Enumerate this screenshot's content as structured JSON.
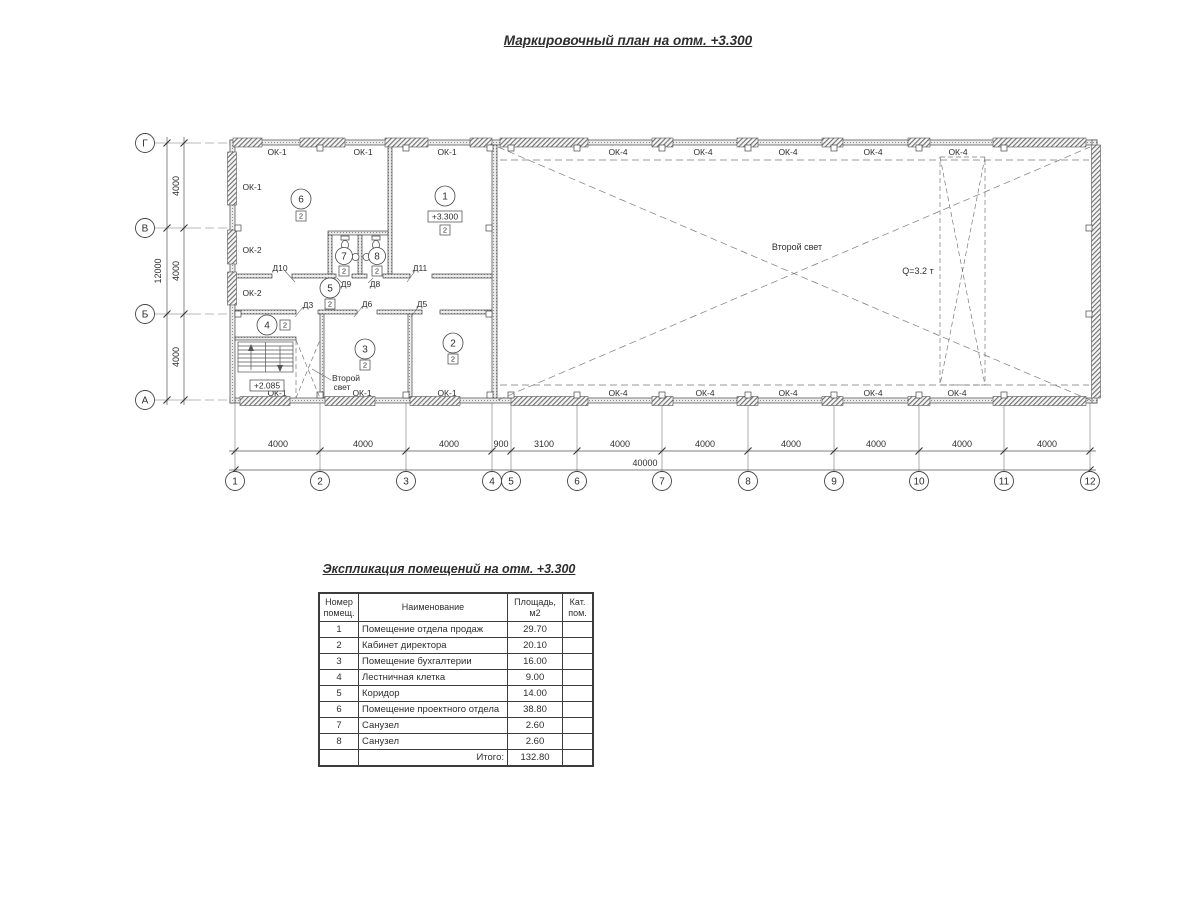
{
  "titles": {
    "plan": "Маркировочный план на отм. +3.300",
    "table": "Экспликация помещений на отм. +3.300"
  },
  "plan": {
    "axis_rows": [
      "Г",
      "В",
      "Б",
      "А"
    ],
    "axis_cols": [
      "1",
      "2",
      "3",
      "4",
      "5",
      "6",
      "7",
      "8",
      "9",
      "10",
      "11",
      "12"
    ],
    "dim_bottom": [
      "4000",
      "4000",
      "4000",
      "900",
      "3100",
      "4000",
      "4000",
      "4000",
      "4000",
      "4000",
      "4000"
    ],
    "dim_bottom_total": "40000",
    "dim_left": [
      "4000",
      "4000",
      "4000"
    ],
    "dim_left_total": "12000",
    "windows_left": [
      "ОК-1",
      "ОК-2",
      "ОК-2"
    ],
    "windows_top_office": [
      "ОК-1",
      "ОК-1",
      "ОК-1"
    ],
    "windows_top_hall": [
      "ОК-4",
      "ОК-4",
      "ОК-4",
      "ОК-4",
      "ОК-4"
    ],
    "windows_bottom_office": [
      "ОК-1",
      "ОК-1",
      "ОК-1"
    ],
    "windows_bottom_hall": [
      "ОК-4",
      "ОК-4",
      "ОК-4",
      "ОК-4",
      "ОК-4"
    ],
    "doors": {
      "d10": "Д10",
      "d9": "Д9",
      "d8": "Д8",
      "d11": "Д11",
      "d3": "Д3",
      "d6": "Д6",
      "d5": "Д5"
    },
    "rooms": {
      "r1": {
        "num": "1",
        "badge": "2",
        "elevation": "+3.300"
      },
      "r2": {
        "num": "2",
        "badge": "2"
      },
      "r3": {
        "num": "3",
        "badge": "2"
      },
      "r4": {
        "num": "4",
        "badge": "2"
      },
      "r5": {
        "num": "5",
        "badge": "2"
      },
      "r6": {
        "num": "6",
        "badge": "2"
      },
      "r7": {
        "num": "7",
        "badge": "2"
      },
      "r8": {
        "num": "8",
        "badge": "2"
      }
    },
    "notes": {
      "stair_elevation": "+2.085",
      "second_light_stairs_line1": "Второй",
      "second_light_stairs_line2": "свет",
      "second_light_hall": "Второй свет",
      "crane": "Q=3.2 т"
    }
  },
  "table": {
    "headers": [
      "Номер помещ.",
      "Наименование",
      "Площадь, м2",
      "Кат. пом."
    ],
    "rows": [
      {
        "num": "1",
        "name": "Помещение отдела продаж",
        "area": "29.70",
        "cat": ""
      },
      {
        "num": "2",
        "name": "Кабинет директора",
        "area": "20.10",
        "cat": ""
      },
      {
        "num": "3",
        "name": "Помещение бухгалтерии",
        "area": "16.00",
        "cat": ""
      },
      {
        "num": "4",
        "name": "Лестничная клетка",
        "area": "9.00",
        "cat": ""
      },
      {
        "num": "5",
        "name": "Коридор",
        "area": "14.00",
        "cat": ""
      },
      {
        "num": "6",
        "name": "Помещение проектного отдела",
        "area": "38.80",
        "cat": ""
      },
      {
        "num": "7",
        "name": "Санузел",
        "area": "2.60",
        "cat": ""
      },
      {
        "num": "8",
        "name": "Санузел",
        "area": "2.60",
        "cat": ""
      }
    ],
    "total_label": "Итого:",
    "total_area": "132.80"
  }
}
